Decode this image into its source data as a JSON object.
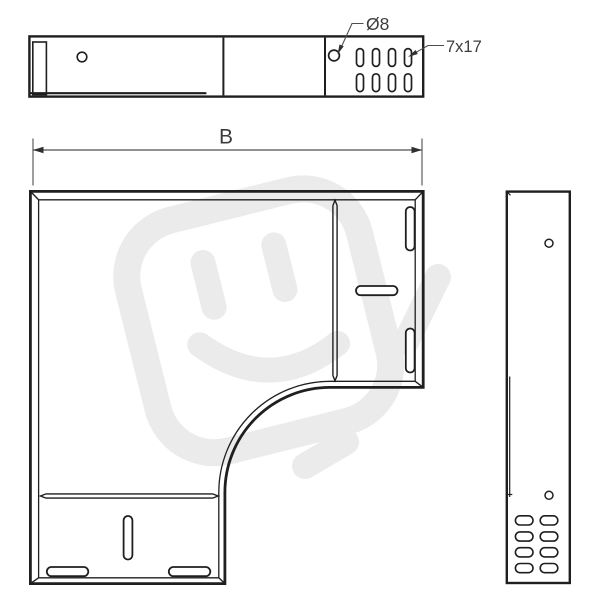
{
  "drawing": {
    "kind": "technical-drawing",
    "subject": "90-degree flat bend tray fitting, three orthographic views"
  },
  "labels": {
    "width_dimension": "B",
    "hole_diameter": "Ø8",
    "slot_size": "7x17"
  },
  "top_view": {
    "slot_count": 8,
    "hole_count": 2
  },
  "plan_view": {
    "slot_count": 6
  },
  "side_view": {
    "slot_count": 8,
    "hole_count": 2
  },
  "colors": {
    "line": "#1f1f1f",
    "dimension_line": "#4f4f4f",
    "text": "#3c3c3c",
    "watermark": "#ebebeb",
    "background": "#ffffff"
  }
}
